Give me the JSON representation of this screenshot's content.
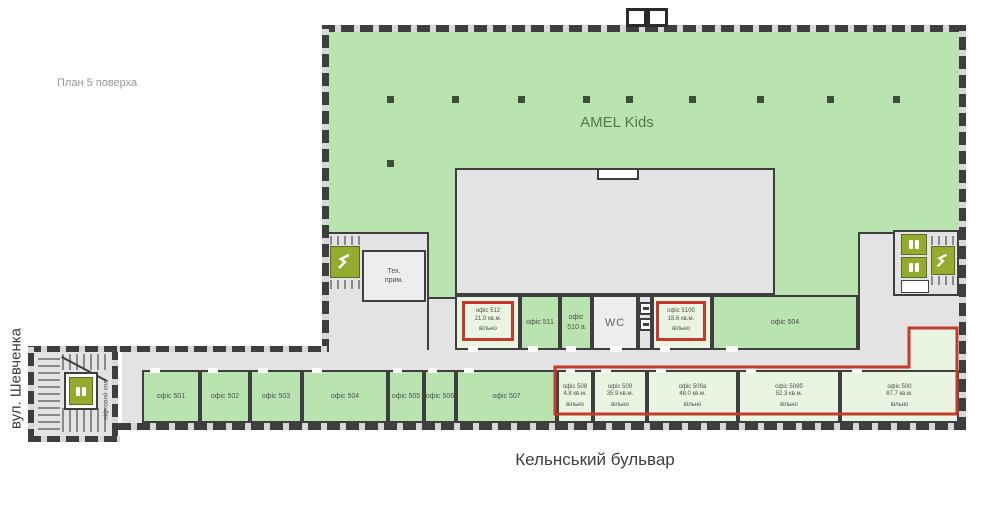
{
  "texts": {
    "plan_label": "План 5 поверха",
    "street_left": "вул. Шевченка",
    "street_bottom": "Кельнський бульвар",
    "tenant": "AMEL Kids",
    "wc": "WC",
    "tech_line1": "Тех.",
    "tech_line2": "прим.",
    "lift_hall": "ліфтовий хол"
  },
  "colors": {
    "occupied_green": "#b9e4b0",
    "vacant_green": "#e9f5e1",
    "corridor_gray": "#e3e3e3",
    "wall_dark": "#3e3e3e",
    "vacant_outline_red": "#c4392b",
    "stair_lift_olive": "#93ac2f"
  },
  "upper_row": [
    {
      "name": "офіс 512",
      "area": "21.0 кв.м.",
      "status": "вільно"
    },
    {
      "name": "офіс 511"
    },
    {
      "name": "офіс 510 а"
    },
    {
      "name": "офіс 510б",
      "area": "18.6 кв.м.",
      "status": "вільно"
    },
    {
      "name": "офіс 504"
    }
  ],
  "bottom_row": [
    {
      "name": "офіс 501"
    },
    {
      "name": "офіс 502"
    },
    {
      "name": "офіс 503"
    },
    {
      "name": "офіс 504"
    },
    {
      "name": "офіс 505"
    },
    {
      "name": "офіс 506"
    },
    {
      "name": "офіс 507"
    },
    {
      "name": "офіс 508",
      "area": "4.8 кв.м.",
      "status": "вільно"
    },
    {
      "name": "офіс 509",
      "area": "35.9 кв.м.",
      "status": "вільно"
    },
    {
      "name": "офіс 509а",
      "area": "48.0 кв.м.",
      "status": "вільно"
    },
    {
      "name": "офіс 509б",
      "area": "52.3 кв.м.",
      "status": "вільно"
    },
    {
      "name": "офіс 500",
      "area": "87.7 кв.м.",
      "status": "вільно"
    }
  ]
}
